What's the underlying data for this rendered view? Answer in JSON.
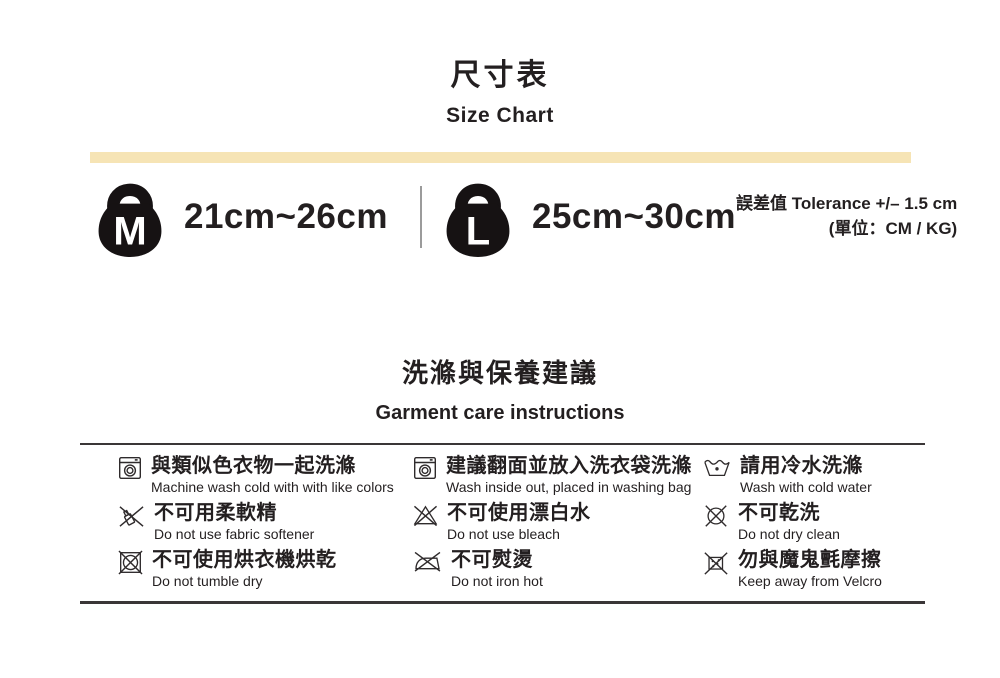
{
  "header": {
    "title_zh": "尺寸表",
    "title_en": "Size Chart"
  },
  "size_section": {
    "items": [
      {
        "label": "M",
        "range": "21cm~26cm"
      },
      {
        "label": "L",
        "range": "25cm~30cm"
      }
    ],
    "tolerance_line1": "誤差值 Tolerance +/– 1.5 cm",
    "tolerance_line2": "(單位：CM / KG)"
  },
  "care": {
    "title_zh": "洗滌與保養建議",
    "title_en": "Garment care instructions",
    "items": [
      {
        "icon": "washing-machine-icon",
        "zh": "與類似色衣物一起洗滌",
        "en": "Machine wash cold with with like colors"
      },
      {
        "icon": "washing-machine-icon",
        "zh": "建議翻面並放入洗衣袋洗滌",
        "en": "Wash inside out, placed in washing bag"
      },
      {
        "icon": "wash-basin-icon",
        "zh": "請用冷水洗滌",
        "en": "Wash with cold water"
      },
      {
        "icon": "no-fabric-softener-icon",
        "zh": "不可用柔軟精",
        "en": "Do not use fabric softener"
      },
      {
        "icon": "no-bleach-icon",
        "zh": "不可使用漂白水",
        "en": "Do not use bleach"
      },
      {
        "icon": "no-dry-clean-icon",
        "zh": "不可乾洗",
        "en": "Do not dry clean"
      },
      {
        "icon": "no-tumble-dry-icon",
        "zh": "不可使用烘衣機烘乾",
        "en": "Do not tumble dry"
      },
      {
        "icon": "no-iron-icon",
        "zh": "不可熨燙",
        "en": "Do not iron hot"
      },
      {
        "icon": "no-velcro-icon",
        "zh": "勿與魔鬼氈摩擦",
        "en": "Keep away from Velcro"
      }
    ]
  },
  "colors": {
    "accent_bar": "#f6e4b5",
    "text": "#231f20"
  }
}
